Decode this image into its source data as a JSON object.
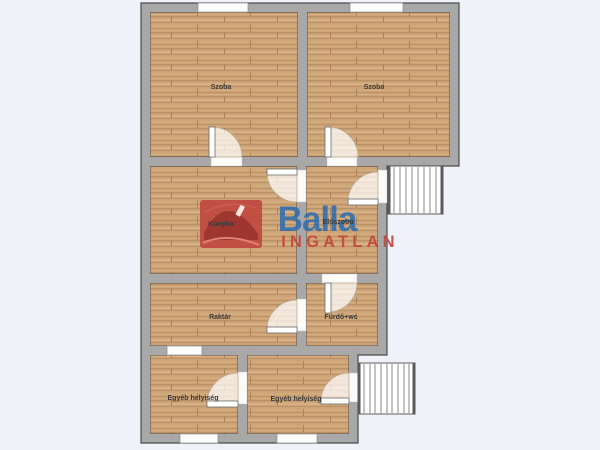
{
  "background_color": "#eff2f8",
  "palette": {
    "wall": "#a8a8a8",
    "wall_outline": "#4c4c4c",
    "floor_wood": "#cda477",
    "watermark_blue": "#2e6fb0",
    "watermark_red": "#c5463d",
    "watermark_logo_red": "#c0493f"
  },
  "watermark": {
    "brand": "Balla",
    "brand_sub": "INGATLAN"
  },
  "floorplan": {
    "rooms": [
      {
        "label": "Szoba"
      },
      {
        "label": "Szoba"
      },
      {
        "label": "Konyha"
      },
      {
        "label": "Előszoba"
      },
      {
        "label": "Raktár"
      },
      {
        "label": "Fürdő+wc"
      },
      {
        "label": "Egyéb helyiség"
      },
      {
        "label": "Egyéb helyiség"
      }
    ]
  }
}
